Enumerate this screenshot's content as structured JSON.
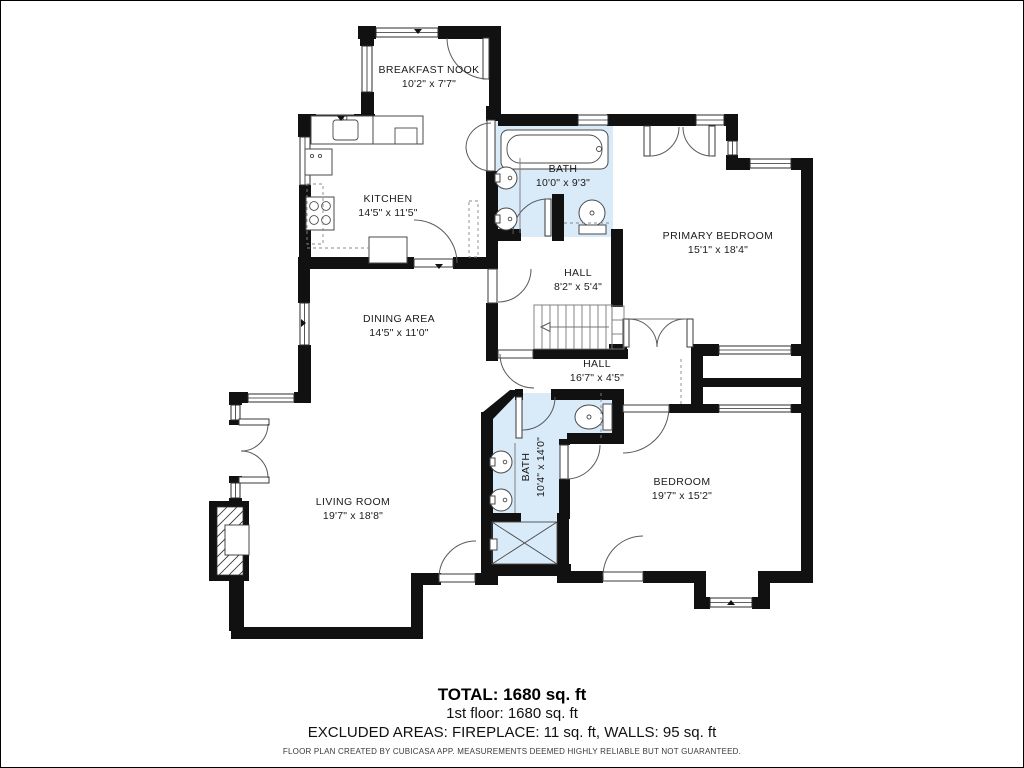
{
  "plan": {
    "rooms": [
      {
        "id": "breakfast-nook",
        "name": "BREAKFAST NOOK",
        "dims": "10'2\" x 7'7\""
      },
      {
        "id": "kitchen",
        "name": "KITCHEN",
        "dims": "14'5\" x 11'5\""
      },
      {
        "id": "bath-upper",
        "name": "BATH",
        "dims": "10'0\" x 9'3\""
      },
      {
        "id": "primary-bedroom",
        "name": "PRIMARY BEDROOM",
        "dims": "15'1\" x 18'4\""
      },
      {
        "id": "hall-upper",
        "name": "HALL",
        "dims": "8'2\" x 5'4\""
      },
      {
        "id": "dining-area",
        "name": "DINING AREA",
        "dims": "14'5\" x 11'0\""
      },
      {
        "id": "hall-lower",
        "name": "HALL",
        "dims": "16'7\" x 4'5\""
      },
      {
        "id": "bath-lower",
        "name": "BATH",
        "dims": "10'4\" x 14'0\""
      },
      {
        "id": "living-room",
        "name": "LIVING ROOM",
        "dims": "19'7\" x 18'8\""
      },
      {
        "id": "bedroom",
        "name": "BEDROOM",
        "dims": "19'7\" x 15'2\""
      }
    ],
    "colors": {
      "wall": "#111111",
      "bath_fill": "#d9eaf8",
      "fixture_line": "#4a4a4a"
    }
  },
  "summary": {
    "total": "TOTAL: 1680 sq. ft",
    "floor": "1st floor: 1680 sq. ft",
    "excluded": "EXCLUDED AREAS: FIREPLACE: 11 sq. ft, WALLS: 95 sq. ft",
    "disclaimer": "FLOOR PLAN CREATED BY CUBICASA APP. MEASUREMENTS DEEMED HIGHLY RELIABLE BUT NOT GUARANTEED."
  }
}
